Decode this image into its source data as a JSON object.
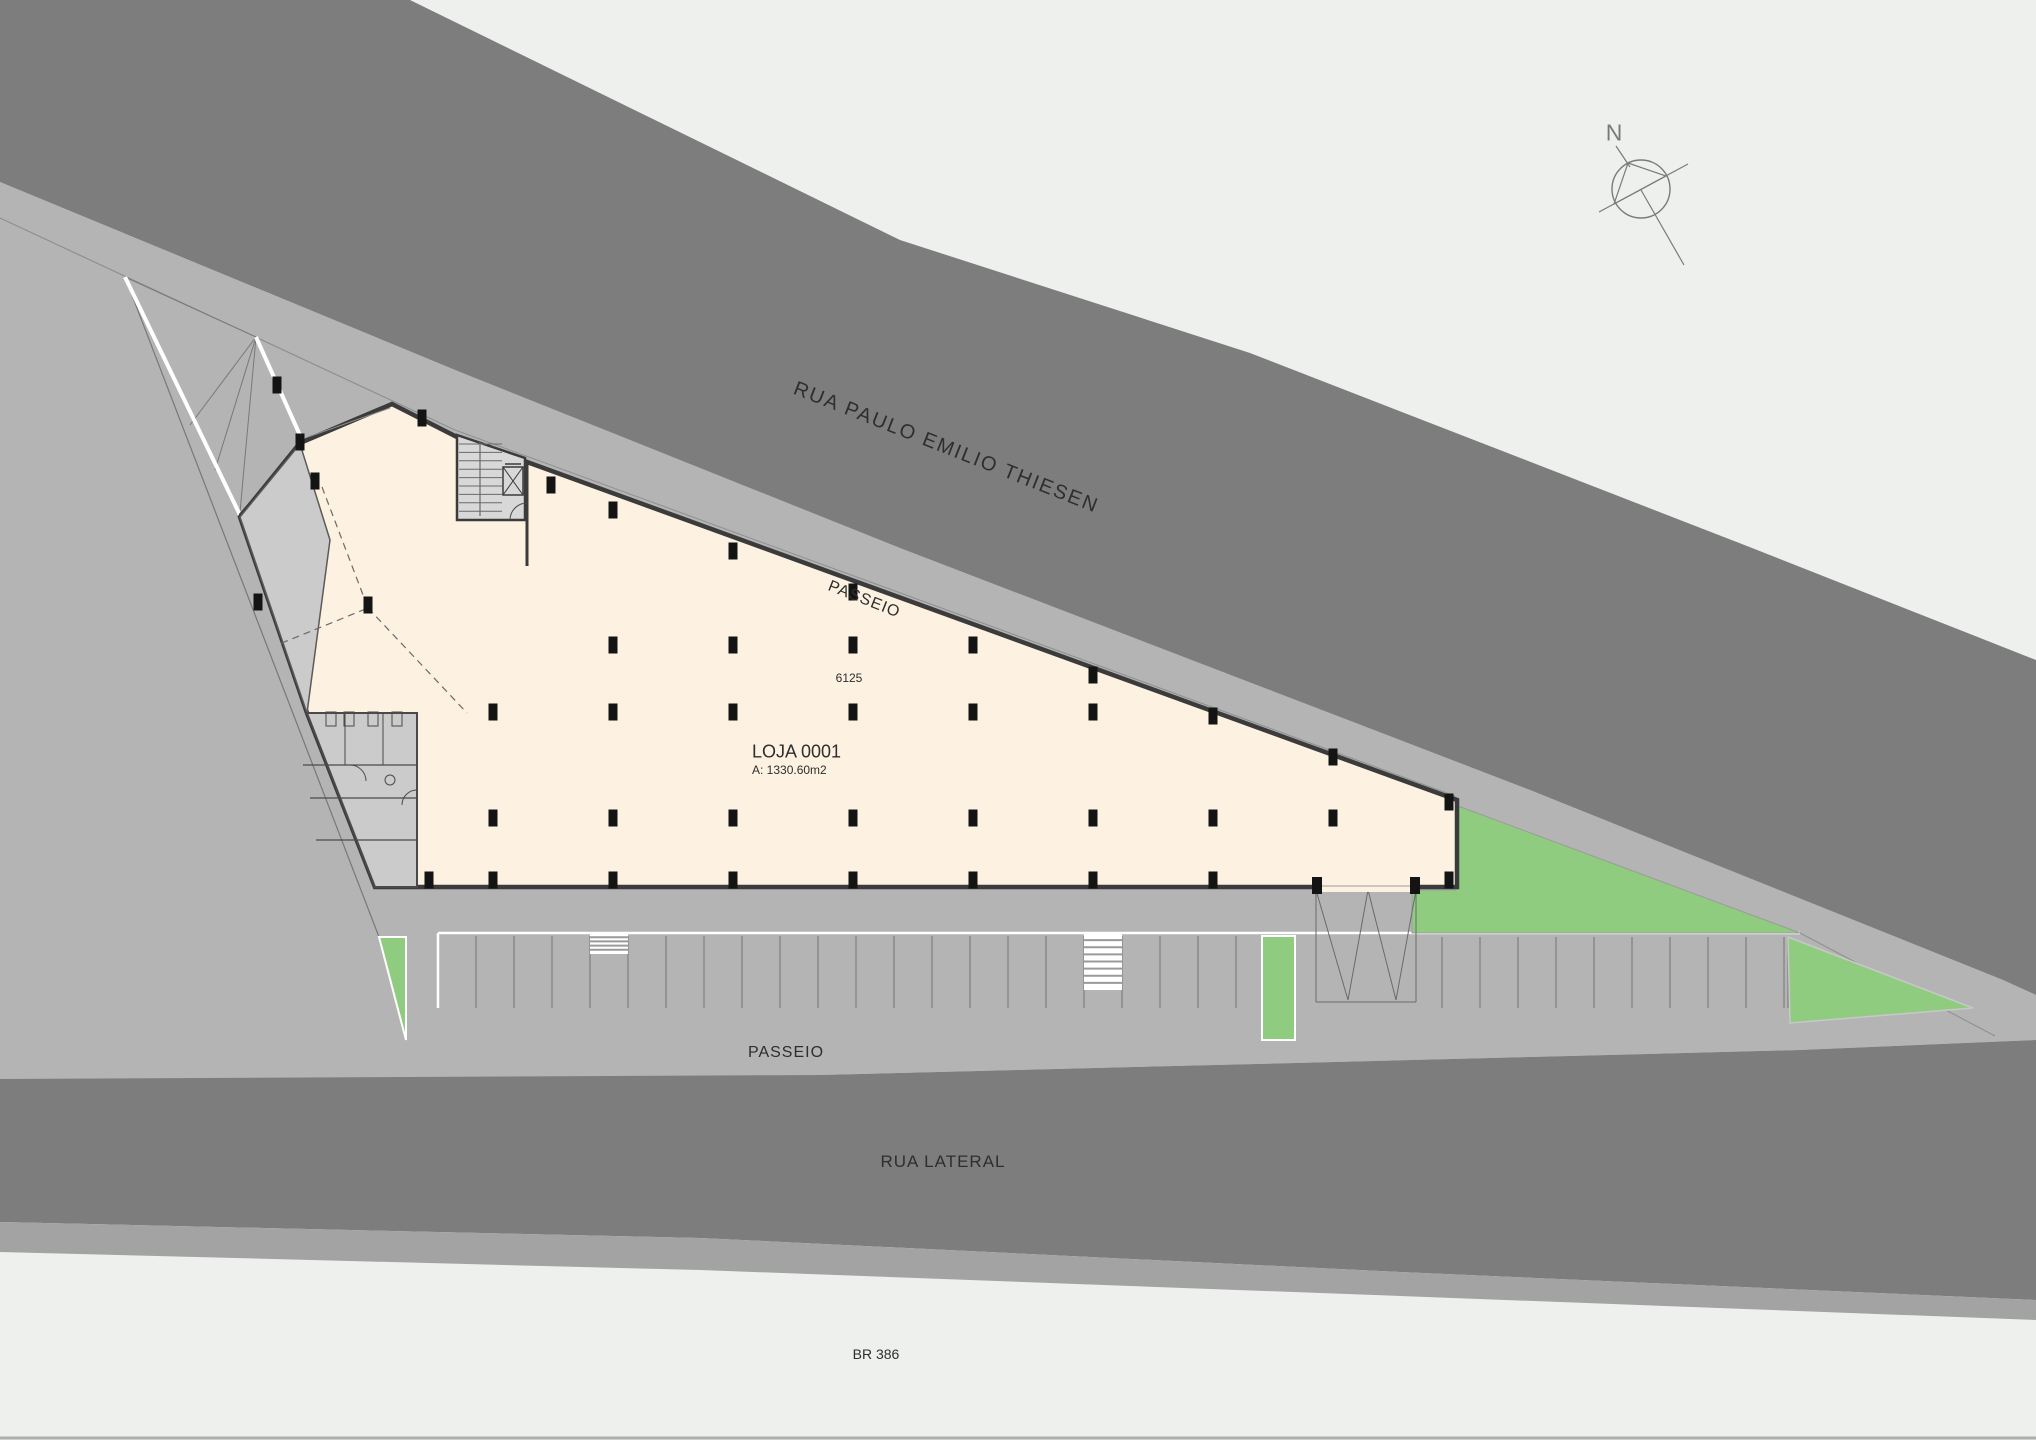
{
  "drawing": {
    "type": "architectural-site-plan",
    "floor_unit": {
      "name": "LOJA 0001",
      "area": "A: 1330.60m2",
      "grid_dimension": "6125"
    },
    "streets": {
      "top_street": "RUA PAULO EMILIO THIESEN",
      "top_sidewalk": "PASSEIO",
      "bottom_sidewalk": "PASSEIO",
      "side_street": "RUA LATERAL",
      "highway": "BR 386"
    },
    "compass": {
      "north_letter": "N"
    }
  },
  "colors": {
    "background": "#eef0ee",
    "road_dark": "#7d7d7d",
    "ground": "#b4b4b4",
    "median": "#a3a3a3",
    "building_fill": "#fdf2e1",
    "wall": "#3b3b3b",
    "room_gray": "#cbcbcb",
    "stair_gray": "#d8d8d8",
    "green": "#90cc80",
    "stall_line": "#868686",
    "thin_line": "#8f8f8f",
    "text": "#2e2e2e",
    "white": "#ffffff"
  },
  "columns": [
    [
      422,
      418
    ],
    [
      300,
      442
    ],
    [
      258,
      602
    ],
    [
      315,
      481
    ],
    [
      368,
      605
    ],
    [
      613,
      645
    ],
    [
      733,
      645
    ],
    [
      853,
      645
    ],
    [
      973,
      645
    ],
    [
      493,
      712
    ],
    [
      613,
      712
    ],
    [
      733,
      712
    ],
    [
      853,
      712
    ],
    [
      973,
      712
    ],
    [
      1093,
      712
    ],
    [
      493,
      818
    ],
    [
      613,
      818
    ],
    [
      733,
      818
    ],
    [
      853,
      818
    ],
    [
      973,
      818
    ],
    [
      1093,
      818
    ],
    [
      1213,
      818
    ],
    [
      1333,
      818
    ],
    [
      613,
      510
    ],
    [
      733,
      551
    ],
    [
      853,
      592
    ],
    [
      1093,
      675
    ],
    [
      1213,
      716
    ],
    [
      1333,
      757
    ],
    [
      1449,
      802
    ],
    [
      429,
      880
    ],
    [
      493,
      880
    ],
    [
      613,
      880
    ],
    [
      733,
      880
    ],
    [
      853,
      880
    ],
    [
      973,
      880
    ],
    [
      1093,
      880
    ],
    [
      1213,
      880
    ],
    [
      1449,
      880
    ],
    [
      277,
      385
    ],
    [
      551,
      485
    ]
  ],
  "parking": {
    "left_row": {
      "start": 438,
      "end": 1250,
      "spacing": 38,
      "top": 936,
      "bottom": 1008
    },
    "right_row": {
      "start": 1404,
      "end": 1788,
      "spacing": 38,
      "top": 937,
      "bottom": 1008
    },
    "crosswalks": [
      {
        "x": 590,
        "y": 933,
        "w": 38,
        "h": 21,
        "stripes": 4
      },
      {
        "x": 1084,
        "y": 933,
        "w": 38,
        "h": 57,
        "stripes": 7
      }
    ]
  }
}
